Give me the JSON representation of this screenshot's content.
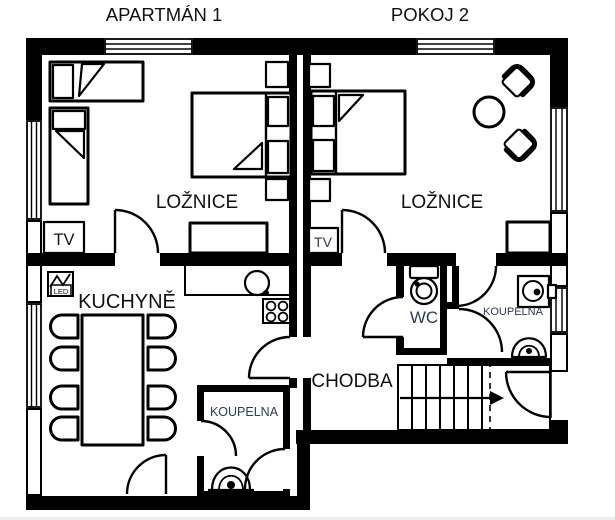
{
  "titles": {
    "unit1": "APARTMÁN 1",
    "unit2": "POKOJ 2"
  },
  "unit1": {
    "bedroom_label": "LOŽNICE",
    "tv_label": "TV",
    "kitchen_label": "KUCHYNĚ",
    "led_label": "LED",
    "bathroom_label": "KOUPELNA"
  },
  "unit2": {
    "bedroom_label": "LOŽNICE",
    "tv_label": "TV",
    "wc_label": "WC",
    "bathroom_label": "KOUPELNA",
    "hallway_label": "CHODBA"
  },
  "colors": {
    "walls": "#000000",
    "labels": "#111111",
    "small_labels": "#2f3a55",
    "background": "#ffffff"
  },
  "icons": [
    "toilet-icon",
    "washing-machine-icon",
    "bathroom-sink-icon",
    "kitchen-sink-icon",
    "stove-icon",
    "led-sign-icon",
    "stairs-arrow-icon",
    "window-symbol",
    "door-swing"
  ]
}
